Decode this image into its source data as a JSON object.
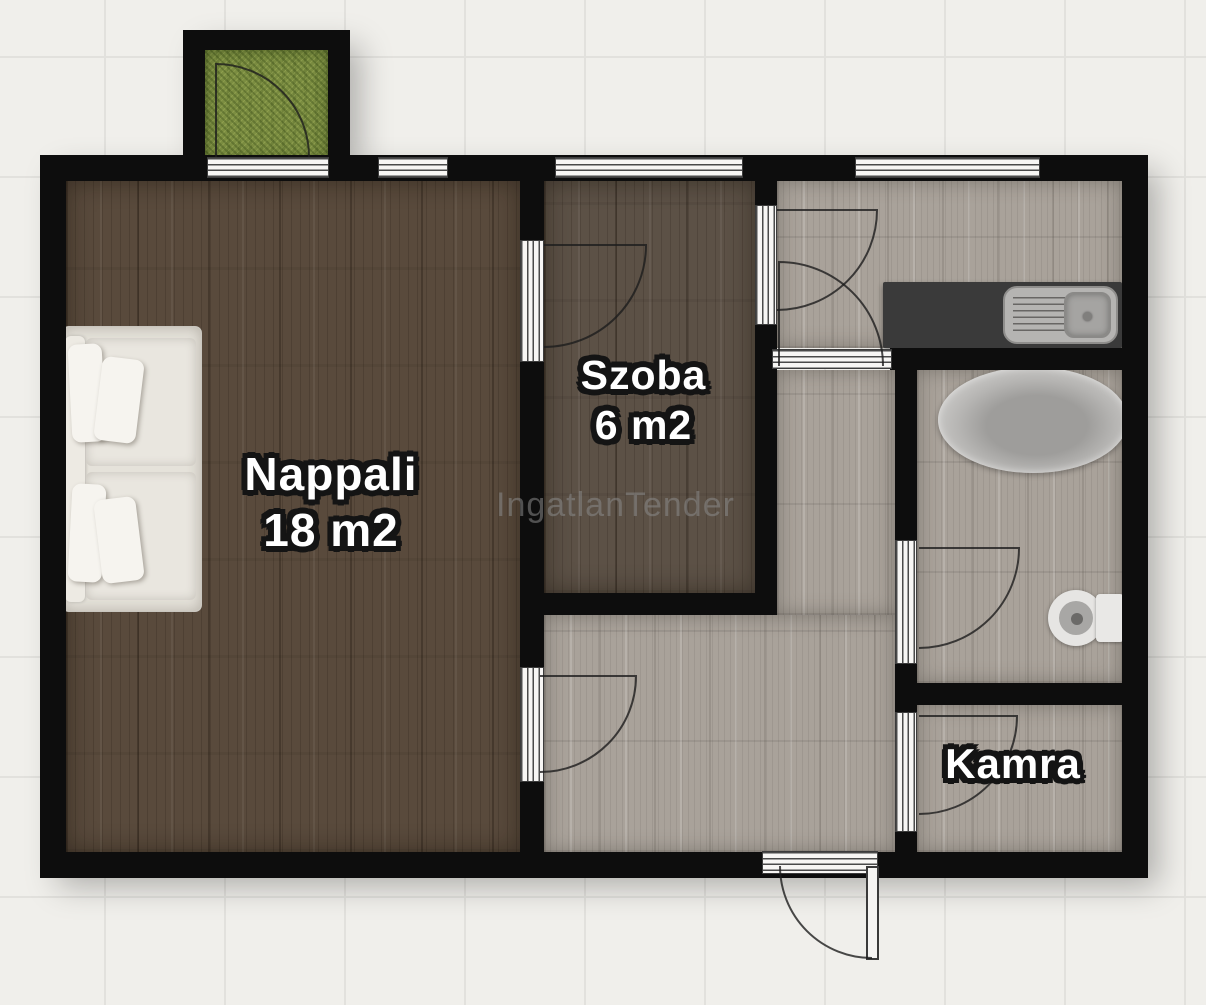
{
  "rooms": {
    "nappali": {
      "name": "Nappali",
      "area": "18 m2"
    },
    "szoba": {
      "name": "Szoba",
      "area": "6 m2"
    },
    "kamra": {
      "name": "Kamra"
    }
  },
  "watermark": {
    "text": "IngatlanTender"
  },
  "colors": {
    "background": "#f0efeb",
    "grid_line": "#e2e1dd",
    "wall": "#0d0d0d",
    "nappali_floor": "#594a3c",
    "szoba_floor": "#5c5146",
    "gray_floor": "#a9a29a",
    "balcony_grass": "#7b8d41",
    "kitchen_counter": "#3a3a3a",
    "label_text": "#ffffff",
    "label_outline": "#141414",
    "watermark_color": "#8a8a8a"
  }
}
